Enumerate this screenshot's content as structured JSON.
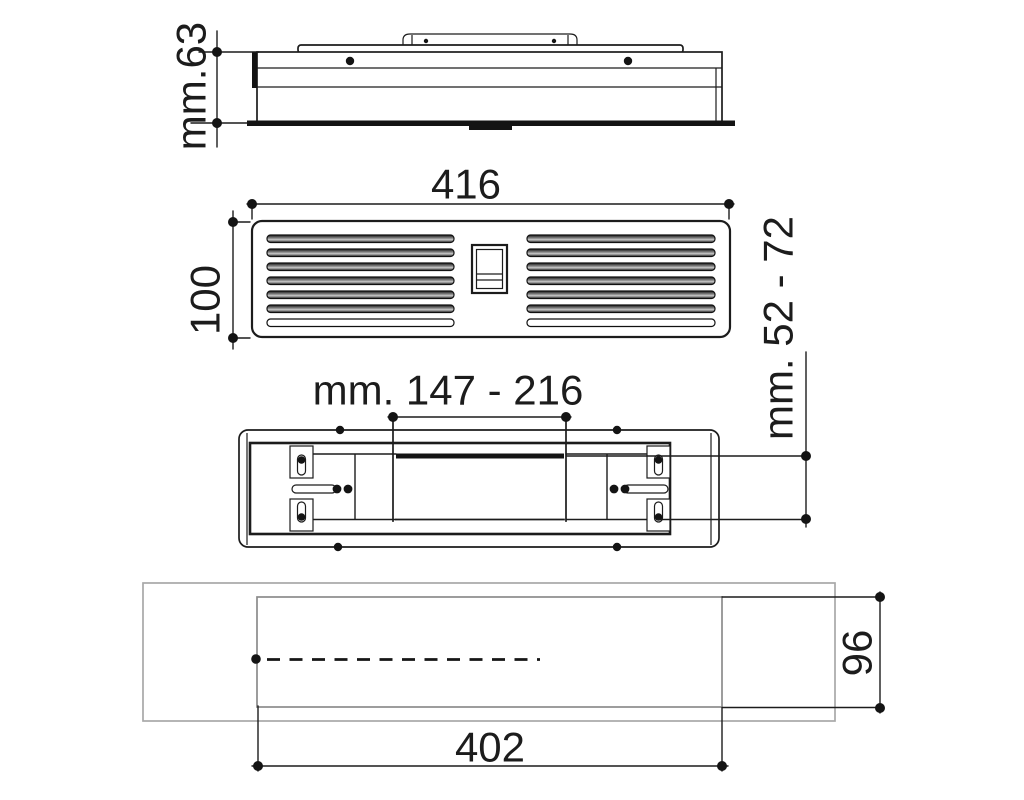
{
  "page": {
    "background": "#ffffff",
    "line_color": "#1c1c1c",
    "panel_gray": "#a8a8a8",
    "opening_gray": "#8c8c8c"
  },
  "views": {
    "side_profile": {
      "description": "side profile of vent unit",
      "dims": {
        "depth": "mm.63"
      }
    },
    "front_grille": {
      "description": "front louvre grille with switch",
      "dims": {
        "width": "416",
        "height": "100"
      }
    },
    "rear_mounting": {
      "description": "rear mounting frame with adjustable slots",
      "dims": {
        "bracket_span": "mm. 147 - 216",
        "recess_depth": "mm. 52 - 72"
      }
    },
    "cutout_template": {
      "description": "panel cutout template",
      "dims": {
        "width": "402",
        "height": "96"
      }
    }
  }
}
